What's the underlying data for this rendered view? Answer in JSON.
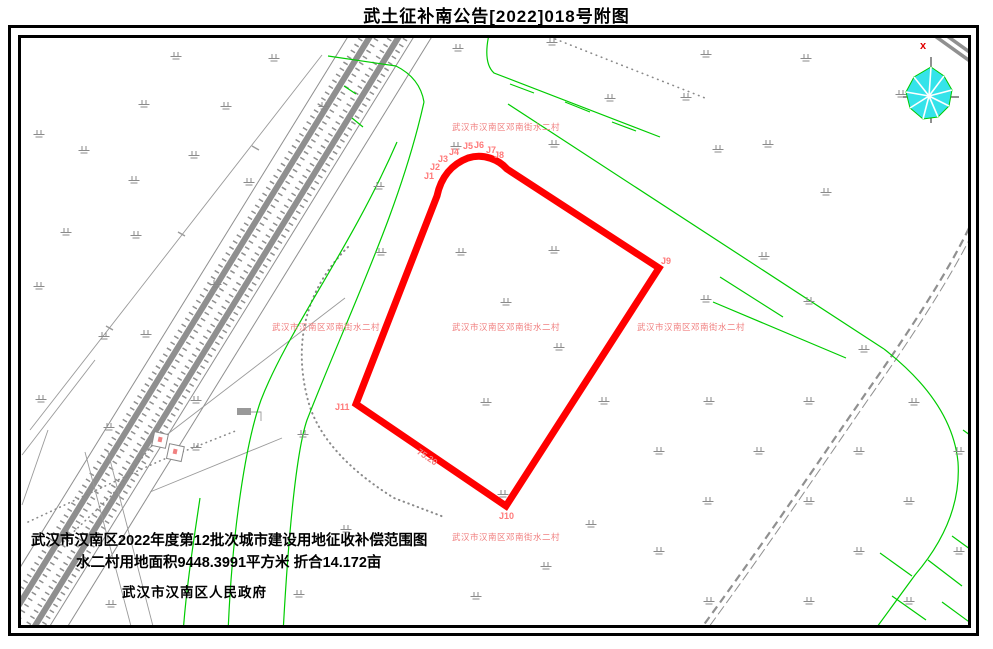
{
  "title": "武土征补南公告[2022]018号附图",
  "annotations": {
    "village_label": "武汉市汉南区邓南街水二村",
    "village_label_positions": [
      [
        452,
        121
      ],
      [
        272,
        321
      ],
      [
        452,
        321
      ],
      [
        637,
        321
      ],
      [
        452,
        531
      ]
    ],
    "boundary_points": [
      {
        "label": "J1",
        "x": 424,
        "y": 171
      },
      {
        "label": "J2",
        "x": 430,
        "y": 162
      },
      {
        "label": "J3",
        "x": 438,
        "y": 154
      },
      {
        "label": "J4",
        "x": 449,
        "y": 147
      },
      {
        "label": "J5",
        "x": 463,
        "y": 141
      },
      {
        "label": "J6",
        "x": 474,
        "y": 140
      },
      {
        "label": "J7",
        "x": 486,
        "y": 145
      },
      {
        "label": "J8",
        "x": 494,
        "y": 150
      },
      {
        "label": "J9",
        "x": 661,
        "y": 256
      },
      {
        "label": "J10",
        "x": 499,
        "y": 511
      },
      {
        "label": "J11",
        "x": 335,
        "y": 402
      }
    ],
    "edge_length_label": "75.20",
    "compass_label": "x"
  },
  "notes": {
    "line1": "武汉市汉南区2022年度第12批次城市建设用地征收补偿范围图",
    "line2": "水二村用地面积9448.3991平方米 折合14.172亩",
    "line3": "武汉市汉南区人民政府"
  },
  "colors": {
    "boundary_red": "#ff0000",
    "label_pink": "#f08080",
    "road_green": "#00cc00",
    "line_gray": "#8f8f8f",
    "compass_cyan": "#35e3ea"
  },
  "grass_positions": [
    [
      170,
      52
    ],
    [
      268,
      54
    ],
    [
      452,
      44
    ],
    [
      546,
      38
    ],
    [
      700,
      50
    ],
    [
      800,
      54
    ],
    [
      895,
      90
    ],
    [
      604,
      94
    ],
    [
      680,
      93
    ],
    [
      138,
      100
    ],
    [
      220,
      102
    ],
    [
      318,
      102
    ],
    [
      33,
      130
    ],
    [
      78,
      146
    ],
    [
      450,
      142
    ],
    [
      548,
      140
    ],
    [
      762,
      140
    ],
    [
      712,
      145
    ],
    [
      188,
      151
    ],
    [
      128,
      176
    ],
    [
      243,
      178
    ],
    [
      373,
      182
    ],
    [
      820,
      188
    ],
    [
      60,
      228
    ],
    [
      130,
      231
    ],
    [
      375,
      248
    ],
    [
      455,
      248
    ],
    [
      548,
      246
    ],
    [
      33,
      282
    ],
    [
      210,
      280
    ],
    [
      500,
      298
    ],
    [
      700,
      295
    ],
    [
      758,
      252
    ],
    [
      803,
      297
    ],
    [
      98,
      332
    ],
    [
      140,
      330
    ],
    [
      553,
      343
    ],
    [
      858,
      345
    ],
    [
      35,
      395
    ],
    [
      190,
      396
    ],
    [
      480,
      398
    ],
    [
      598,
      397
    ],
    [
      703,
      397
    ],
    [
      803,
      397
    ],
    [
      908,
      398
    ],
    [
      103,
      423
    ],
    [
      297,
      430
    ],
    [
      653,
      447
    ],
    [
      753,
      447
    ],
    [
      853,
      447
    ],
    [
      953,
      447
    ],
    [
      190,
      443
    ],
    [
      497,
      490
    ],
    [
      702,
      497
    ],
    [
      803,
      497
    ],
    [
      903,
      497
    ],
    [
      60,
      530
    ],
    [
      340,
      525
    ],
    [
      585,
      520
    ],
    [
      653,
      547
    ],
    [
      853,
      547
    ],
    [
      953,
      547
    ],
    [
      293,
      590
    ],
    [
      105,
      600
    ],
    [
      470,
      592
    ],
    [
      540,
      562
    ],
    [
      703,
      597
    ],
    [
      803,
      597
    ],
    [
      903,
      597
    ]
  ]
}
